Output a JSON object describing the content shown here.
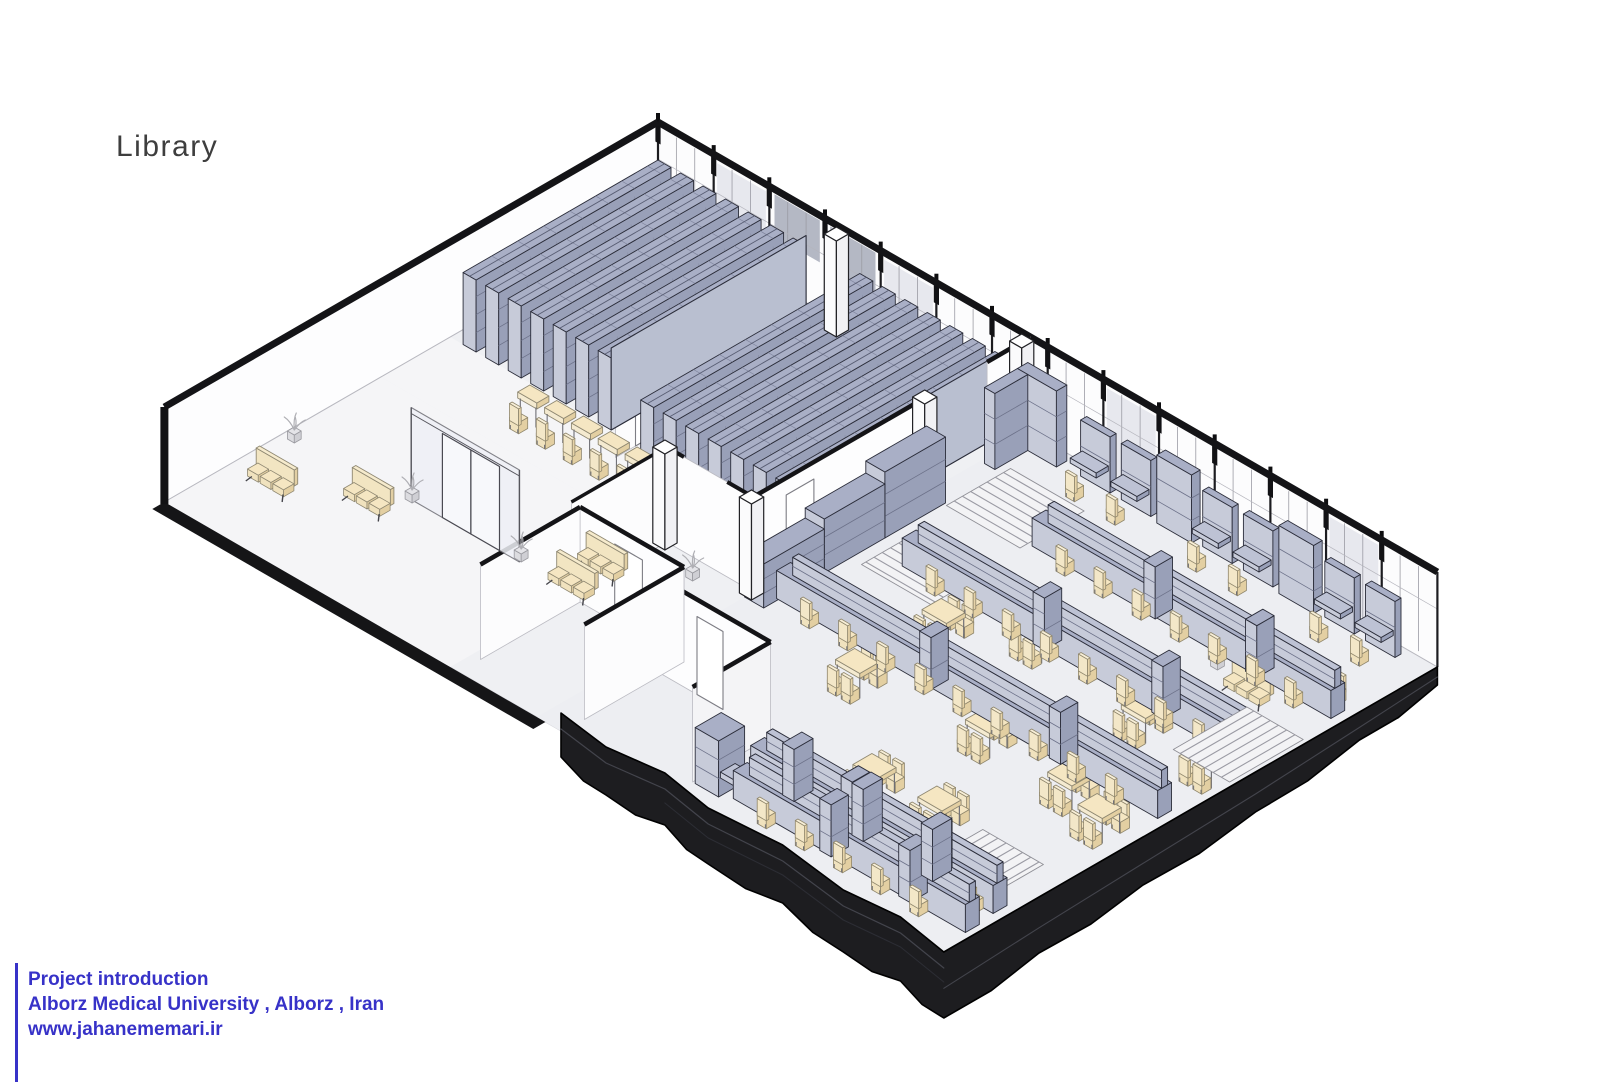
{
  "page": {
    "background": "#ffffff"
  },
  "title": {
    "text": "Library",
    "color": "#3e3e3e"
  },
  "footer": {
    "accent_color": "#3732c8",
    "lines": [
      "Project introduction",
      "Alborz Medical University , Alborz , Iran",
      "www.jahanememari.ir"
    ]
  },
  "palette": {
    "outline": "#2b2d3a",
    "wall_stroke": "#141417",
    "lavender_top": "#a9afc6",
    "lavender_top_light": "#bdc2d4",
    "lavender_sw": "#c7cbd9",
    "lavender_se": "#99a0b8",
    "beige_top": "#f5e6c2",
    "beige_side": "#e3cfa2",
    "chair_stroke": "#8f866c",
    "floor": "#eff0f3",
    "floor_light": "#f5f5f7",
    "step_line": "#9b9ba4",
    "slab": "#1d1d20",
    "slab_line": "#43444c",
    "glass": "#eef0f6",
    "plant_stroke": "#afafb4"
  },
  "scene": {
    "stacks": {
      "groups": 2,
      "rows_per_group": 7
    },
    "corridor_desks": 7,
    "lobby": {
      "benches": 4,
      "plants": 3
    },
    "reading_room": {
      "long_table_rows": 5,
      "four_seat_tables": 10,
      "wall_carrels": 8,
      "stair_runs": 4,
      "entry_bench": 1,
      "entry_plant": 1
    },
    "windows": {
      "bays": 14,
      "tinted_bays": [
        1,
        4,
        8,
        12
      ],
      "shaded_bays": [
        2,
        3
      ]
    }
  }
}
